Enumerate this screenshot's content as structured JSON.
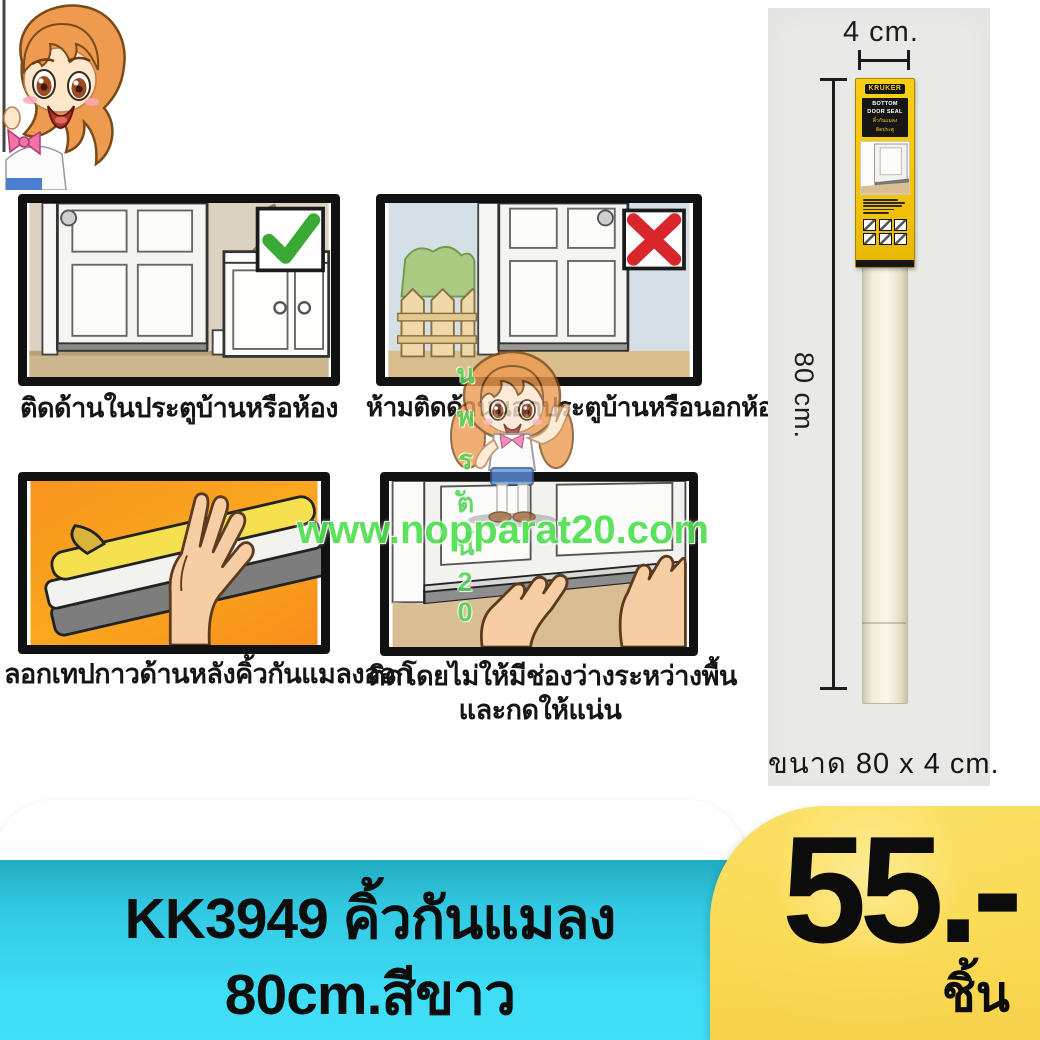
{
  "watermark": {
    "url": "www.nopparat20.com",
    "vertical": "นพรัตน์20",
    "color": "#4FE04F"
  },
  "instructions": {
    "panels": [
      {
        "caption": "ติดด้านในประตูบ้านหรือห้อง",
        "mark": "check"
      },
      {
        "caption": "ห้ามติดด้านนอกประตูบ้านหรือนอกห้อง",
        "mark": "cross"
      },
      {
        "caption": "ลอกเทปกาวด้านหลังคิ้วกันแมลงออก",
        "mark": "none"
      },
      {
        "caption": "ติดโดยไม่ให้มีช่องว่างระหว่างพื้น",
        "caption2": "และกดให้แน่น",
        "mark": "none"
      }
    ]
  },
  "photo": {
    "width_label": "4 cm.",
    "height_label": "80 cm.",
    "size_caption": "ขนาด 80 x 4 cm.",
    "package": {
      "brand": "KRUKER",
      "title_line1": "BOTTOM",
      "title_line2": "DOOR SEAL",
      "thai_line1": "คิ้วกันแมลง",
      "thai_line2": "ติดประตู"
    }
  },
  "footer": {
    "title_line1": "KK3949 คิ้วกันแมลง",
    "title_line2": "80cm.สีขาว",
    "price": "55.-",
    "unit": "ชิ้น",
    "panel_color": "#3EDCF5",
    "price_box_color": "#FBDB55"
  }
}
